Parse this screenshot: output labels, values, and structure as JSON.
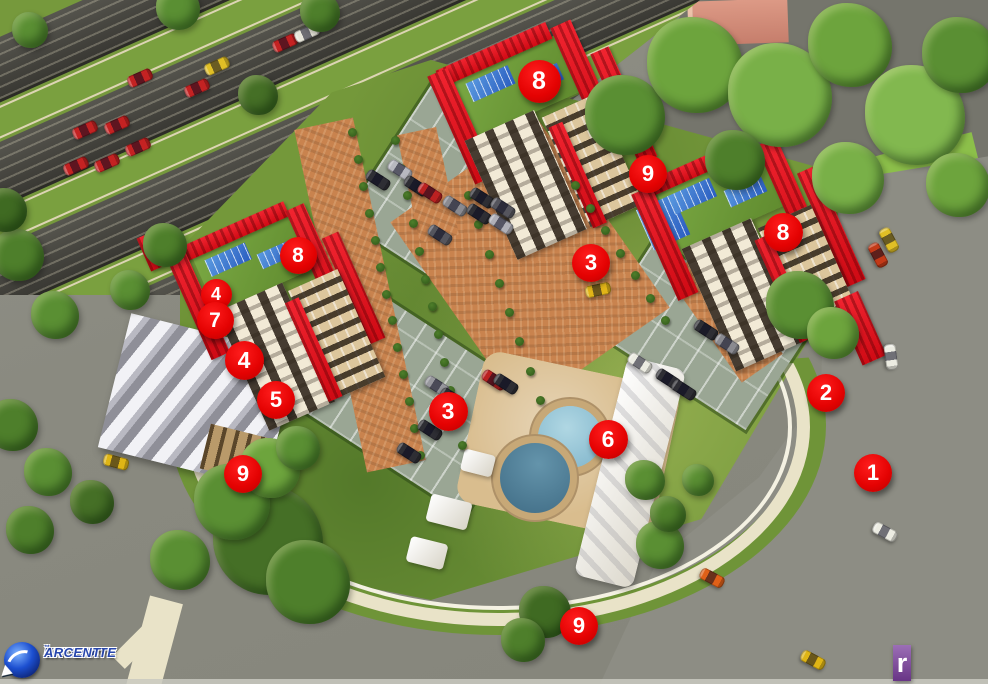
{
  "markers": [
    {
      "n": "8",
      "x": 539,
      "y": 81,
      "s": 43
    },
    {
      "n": "9",
      "x": 648,
      "y": 174,
      "s": 38
    },
    {
      "n": "3",
      "x": 591,
      "y": 263,
      "s": 38
    },
    {
      "n": "8",
      "x": 783,
      "y": 232,
      "s": 39
    },
    {
      "n": "8",
      "x": 298,
      "y": 255,
      "s": 37
    },
    {
      "n": "4",
      "x": 216,
      "y": 294,
      "s": 31
    },
    {
      "n": "7",
      "x": 215,
      "y": 320,
      "s": 37
    },
    {
      "n": "4",
      "x": 244,
      "y": 360,
      "s": 39
    },
    {
      "n": "5",
      "x": 276,
      "y": 400,
      "s": 38
    },
    {
      "n": "2",
      "x": 826,
      "y": 393,
      "s": 38
    },
    {
      "n": "3",
      "x": 448,
      "y": 411,
      "s": 39
    },
    {
      "n": "6",
      "x": 608,
      "y": 439,
      "s": 39
    },
    {
      "n": "9",
      "x": 243,
      "y": 474,
      "s": 38
    },
    {
      "n": "1",
      "x": 873,
      "y": 473,
      "s": 38
    },
    {
      "n": "9",
      "x": 579,
      "y": 626,
      "s": 38
    }
  ],
  "branding": {
    "enterate": {
      "line1": "ENTERATE",
      "line2": "ARCENT",
      "trademark": "™"
    },
    "estar": {
      "text": "estar",
      "letters": [
        {
          "ch": "e",
          "bg": "#eda33b"
        },
        {
          "ch": "s",
          "bg": "#d7301f"
        },
        {
          "ch": "t",
          "bg": "#cc2366"
        },
        {
          "ch": "a",
          "bg": "#1d2e6e"
        },
        {
          "ch": "r",
          "bg": "#7a3e9d"
        }
      ]
    }
  },
  "palette": {
    "marker_red": "#e40202",
    "marker_text": "#ffffff",
    "building_red": "#e5101e",
    "pool_light": "#8fc3d6",
    "pool_dark": "#4e7f98",
    "deck_tan": "#d9bd8e",
    "grass": "#74983a",
    "lawn_bright": "#8cbf4a",
    "roof_green": "#6f9a3a",
    "solar_blue": "#2f6fd0",
    "facade_cream": "#f2ead6",
    "facade_tan": "#dcc69c",
    "window_dark": "#2a2118",
    "path_orange": "#c9834e",
    "parking_gray": "#9aa694",
    "road_gray": "#8d8d84",
    "pavement_gray": "#75756c",
    "sidewalk_cream": "#e9e3c8",
    "market_roof": "#4a4a44",
    "pink_building": "#d4907c"
  },
  "cars": [
    [
      217,
      66,
      "#e0bf26",
      -24
    ],
    [
      197,
      88,
      "#c42222",
      -24
    ],
    [
      285,
      43,
      "#c42222",
      -24
    ],
    [
      307,
      33,
      "#e8e6da",
      -24
    ],
    [
      85,
      130,
      "#c42222",
      -24
    ],
    [
      117,
      125,
      "#c42222",
      -24
    ],
    [
      138,
      147,
      "#c42222",
      -24
    ],
    [
      107,
      163,
      "#c42222",
      -24
    ],
    [
      76,
      166,
      "#c42222",
      -24
    ],
    [
      140,
      78,
      "#c42222",
      -24
    ],
    [
      889,
      240,
      "#e0bf26",
      62
    ],
    [
      878,
      255,
      "#c43a18",
      62
    ],
    [
      891,
      357,
      "#ecece2",
      82
    ],
    [
      885,
      532,
      "#ecece2",
      28
    ],
    [
      712,
      578,
      "#e06018",
      28
    ],
    [
      813,
      660,
      "#dfb515",
      28
    ],
    [
      378,
      180,
      "#2e2e34",
      33
    ],
    [
      400,
      170,
      "#b8b8c0",
      33
    ],
    [
      416,
      186,
      "#2e2e34",
      33
    ],
    [
      430,
      193,
      "#bb2121",
      33
    ],
    [
      455,
      206,
      "#8a8a90",
      33
    ],
    [
      479,
      214,
      "#2e2e34",
      33
    ],
    [
      501,
      224,
      "#b0b0b8",
      33
    ],
    [
      440,
      235,
      "#55555d",
      33
    ],
    [
      598,
      290,
      "#e2b518",
      -12
    ],
    [
      430,
      430,
      "#2e2e34",
      33
    ],
    [
      409,
      453,
      "#2e2e34",
      33
    ],
    [
      437,
      386,
      "#97979d",
      33
    ],
    [
      494,
      380,
      "#bb2121",
      33
    ],
    [
      506,
      384,
      "#2e2e34",
      33
    ],
    [
      452,
      398,
      "#2e2e34",
      33
    ],
    [
      640,
      363,
      "#ecece2",
      33
    ],
    [
      668,
      379,
      "#2e2e34",
      33
    ],
    [
      684,
      390,
      "#2e2e34",
      33
    ],
    [
      706,
      330,
      "#2e2e34",
      33
    ],
    [
      727,
      344,
      "#8a8a90",
      33
    ],
    [
      482,
      198,
      "#2e2e34",
      33
    ],
    [
      503,
      208,
      "#55555d",
      33
    ],
    [
      116,
      462,
      "#dfb515",
      15
    ]
  ],
  "trees": [
    [
      625,
      115,
      40,
      "#5a8f33"
    ],
    [
      695,
      65,
      48,
      "#6da43d"
    ],
    [
      780,
      95,
      52,
      "#79b048"
    ],
    [
      850,
      45,
      42,
      "#6da43d"
    ],
    [
      915,
      115,
      50,
      "#82b84f"
    ],
    [
      960,
      55,
      38,
      "#5a8f33"
    ],
    [
      958,
      185,
      32,
      "#6da43d"
    ],
    [
      848,
      178,
      36,
      "#79b048"
    ],
    [
      735,
      160,
      30,
      "#4e7f2b"
    ],
    [
      800,
      305,
      34,
      "#5a8f33"
    ],
    [
      833,
      333,
      26,
      "#6da43d"
    ],
    [
      18,
      255,
      26,
      "#4e7f2b"
    ],
    [
      55,
      315,
      24,
      "#5a8f33"
    ],
    [
      12,
      425,
      26,
      "#4e7f2b"
    ],
    [
      48,
      472,
      24,
      "#5a8f33"
    ],
    [
      92,
      502,
      22,
      "#456f26"
    ],
    [
      30,
      530,
      24,
      "#4e7f2b"
    ],
    [
      5,
      210,
      22,
      "#3f6a22"
    ],
    [
      268,
      540,
      55,
      "#456f26"
    ],
    [
      232,
      502,
      38,
      "#5a8f33"
    ],
    [
      308,
      582,
      42,
      "#4e7f2b"
    ],
    [
      180,
      560,
      30,
      "#5a8f33"
    ],
    [
      545,
      612,
      26,
      "#3f6a22"
    ],
    [
      523,
      640,
      22,
      "#4e7f2b"
    ],
    [
      660,
      545,
      24,
      "#5a8f33"
    ],
    [
      645,
      480,
      20,
      "#5a8f33"
    ],
    [
      668,
      514,
      18,
      "#4e7f2b"
    ],
    [
      698,
      480,
      16,
      "#5a8f33"
    ],
    [
      270,
      468,
      30,
      "#6da43d"
    ],
    [
      298,
      448,
      22,
      "#5a8f33"
    ],
    [
      178,
      8,
      22,
      "#5a8f33"
    ],
    [
      320,
      12,
      20,
      "#4e7f2b"
    ],
    [
      30,
      30,
      18,
      "#5a8f33"
    ],
    [
      258,
      95,
      20,
      "#456f26"
    ],
    [
      165,
      245,
      22,
      "#4e7f2b"
    ],
    [
      130,
      290,
      20,
      "#5a8f33"
    ]
  ],
  "palm_rows": [
    [
      352,
      132,
      420,
      455,
      13
    ],
    [
      395,
      140,
      462,
      445,
      12
    ],
    [
      468,
      195,
      540,
      400,
      8
    ],
    [
      575,
      185,
      665,
      320,
      7
    ]
  ]
}
